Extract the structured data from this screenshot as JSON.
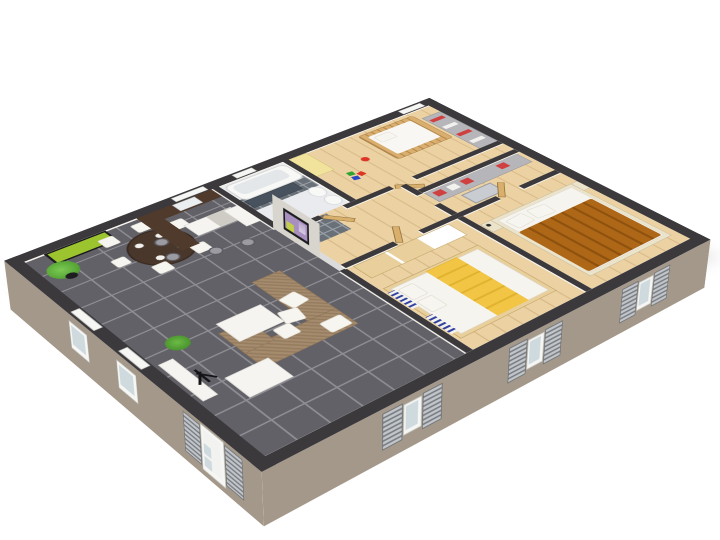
{
  "image": {
    "title": "3D isometric cutaway floor plan of a three-bedroom home",
    "style": "architectural render, white background, dark charcoal wall tops, taupe exterior wall faces"
  },
  "colors": {
    "wall-top": "#3b393c",
    "wall-face": "#a39889",
    "wall-inner": "#f6f3ec",
    "floor-tile": "#616167",
    "tile-grout": "#8f8f95",
    "wood-floor": "#ecd2a2",
    "wood-plank": "#d9bb8a",
    "bath-floor": "#e9ebee",
    "counter-wood": "#503a2b",
    "white-furniture": "#f5f4f0",
    "sofa": "#a68c6e",
    "sofa-dark": "#977d5f",
    "table-wood": "#4a372b",
    "plant-green": "#56a536",
    "pot-black": "#1e1e20",
    "art-green": "#9cc42f",
    "tv-frame": "#1c1c1e",
    "tv-screen": "#a78fbf",
    "tv-accent": "#c3cf49",
    "bath-counter": "#47525e",
    "crib-wood": "#d9ae6e",
    "toy-red": "#dd3527",
    "toy-green": "#2fa32f",
    "toy-blue": "#2b46c6",
    "wardrobe-yellow": "#f1e39c",
    "closet-gray": "#b5b5ba",
    "clothes-red": "#cf4040",
    "blanket-yellow": "#f2c545",
    "duvet-orange": "#ad6717",
    "duvet-shadow": "#8f520e",
    "bed-frame": "#ece3cb",
    "bed2-frame": "#e8cf9b",
    "door-wood": "#d9b06b",
    "shutter-light": "#c2c6ca",
    "shutter-dark": "#787d83",
    "window-glass": "#cfdade",
    "accent-blue": "#2f3f9e"
  },
  "rooms": [
    {
      "id": "living-dining-kitchen",
      "floor": "dark-gray-tile",
      "furniture": [
        "u-shaped-corner-sofa",
        "white-cushions",
        "coffee-table",
        "white-mat",
        "round-dining-table",
        "white-dining-chairs",
        "place-settings",
        "green-wall-art",
        "potted-plant-large",
        "potted-plant-small",
        "black-floor-lamp",
        "white-bench",
        "tv-half-wall",
        "flat-screen-tv",
        "kitchen-l-counter",
        "kitchen-sink",
        "white-island",
        "fridge",
        "bar-stools",
        "glass-entry-door"
      ]
    },
    {
      "id": "bathroom",
      "floor": "light-tile",
      "furniture": [
        "bathtub",
        "dark-vanity-counter",
        "toilet",
        "bidet"
      ]
    },
    {
      "id": "hallway",
      "floor": "light-wood",
      "furniture": [
        "open-wood-doors",
        "gray-tile-patch"
      ]
    },
    {
      "id": "nursery",
      "floor": "light-wood",
      "furniture": [
        "wooden-crib",
        "yellow-wardrobe",
        "toy-ball",
        "toy-blocks",
        "closet-shelves-red-clothes"
      ]
    },
    {
      "id": "dressing-area",
      "floor": "light-wood",
      "furniture": [
        "gray-shelving-red-clothes",
        "mirror-frame"
      ]
    },
    {
      "id": "bedroom-small",
      "floor": "light-wood",
      "furniture": [
        "double-bed-white-linen",
        "yellow-throw-blanket",
        "wood-shelf-unit",
        "blue-striped-window-panels"
      ]
    },
    {
      "id": "bedroom-master",
      "floor": "light-wood",
      "furniture": [
        "double-bed-orange-duvet",
        "white-pillows",
        "nightstands",
        "cream-bed-frame"
      ]
    }
  ],
  "exterior": {
    "walls": "taupe faces with dark charcoal cut tops",
    "features": [
      "louvered-shutter-pairs",
      "white-window-frames",
      "glass-front-door",
      "soft-ground-shadow"
    ]
  }
}
